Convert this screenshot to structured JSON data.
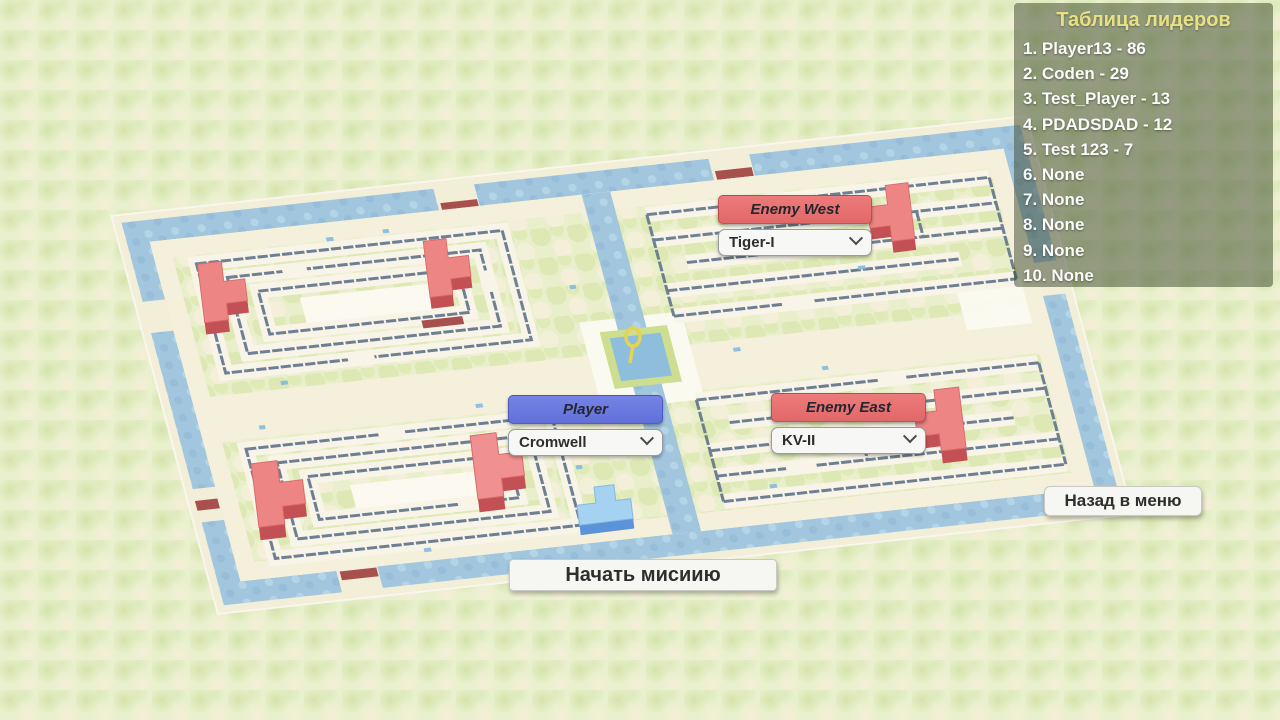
{
  "leaderboard": {
    "title": "Таблица лидеров",
    "entries": [
      "1. Player13 - 86",
      "2. Coden - 29",
      "3. Test_Player - 13",
      "4. PDADSDAD - 12",
      "5. Test 123 - 7",
      "6. None",
      "7. None",
      "8. None",
      "9. None",
      "10. None"
    ]
  },
  "selectors": {
    "enemy_west": {
      "label": "Enemy West",
      "selected": "Tiger-I"
    },
    "player": {
      "label": "Player",
      "selected": "Cromwell"
    },
    "enemy_east": {
      "label": "Enemy East",
      "selected": "KV-II"
    }
  },
  "buttons": {
    "back": "Назад в меню",
    "start": "Начать мисиию"
  },
  "icons": {
    "dropdown": "chevron-down"
  },
  "colors": {
    "enemy_accent": "#e96e6e",
    "player_accent": "#6b7de0",
    "leaderboard_title": "#e8e183",
    "leaderboard_bg": "rgba(58,70,44,0.5)",
    "water": "#a2c6de",
    "enemy_tank_top": "#ee8181",
    "player_tank_top": "#a5d2f0",
    "background": "#e9f0cd"
  }
}
